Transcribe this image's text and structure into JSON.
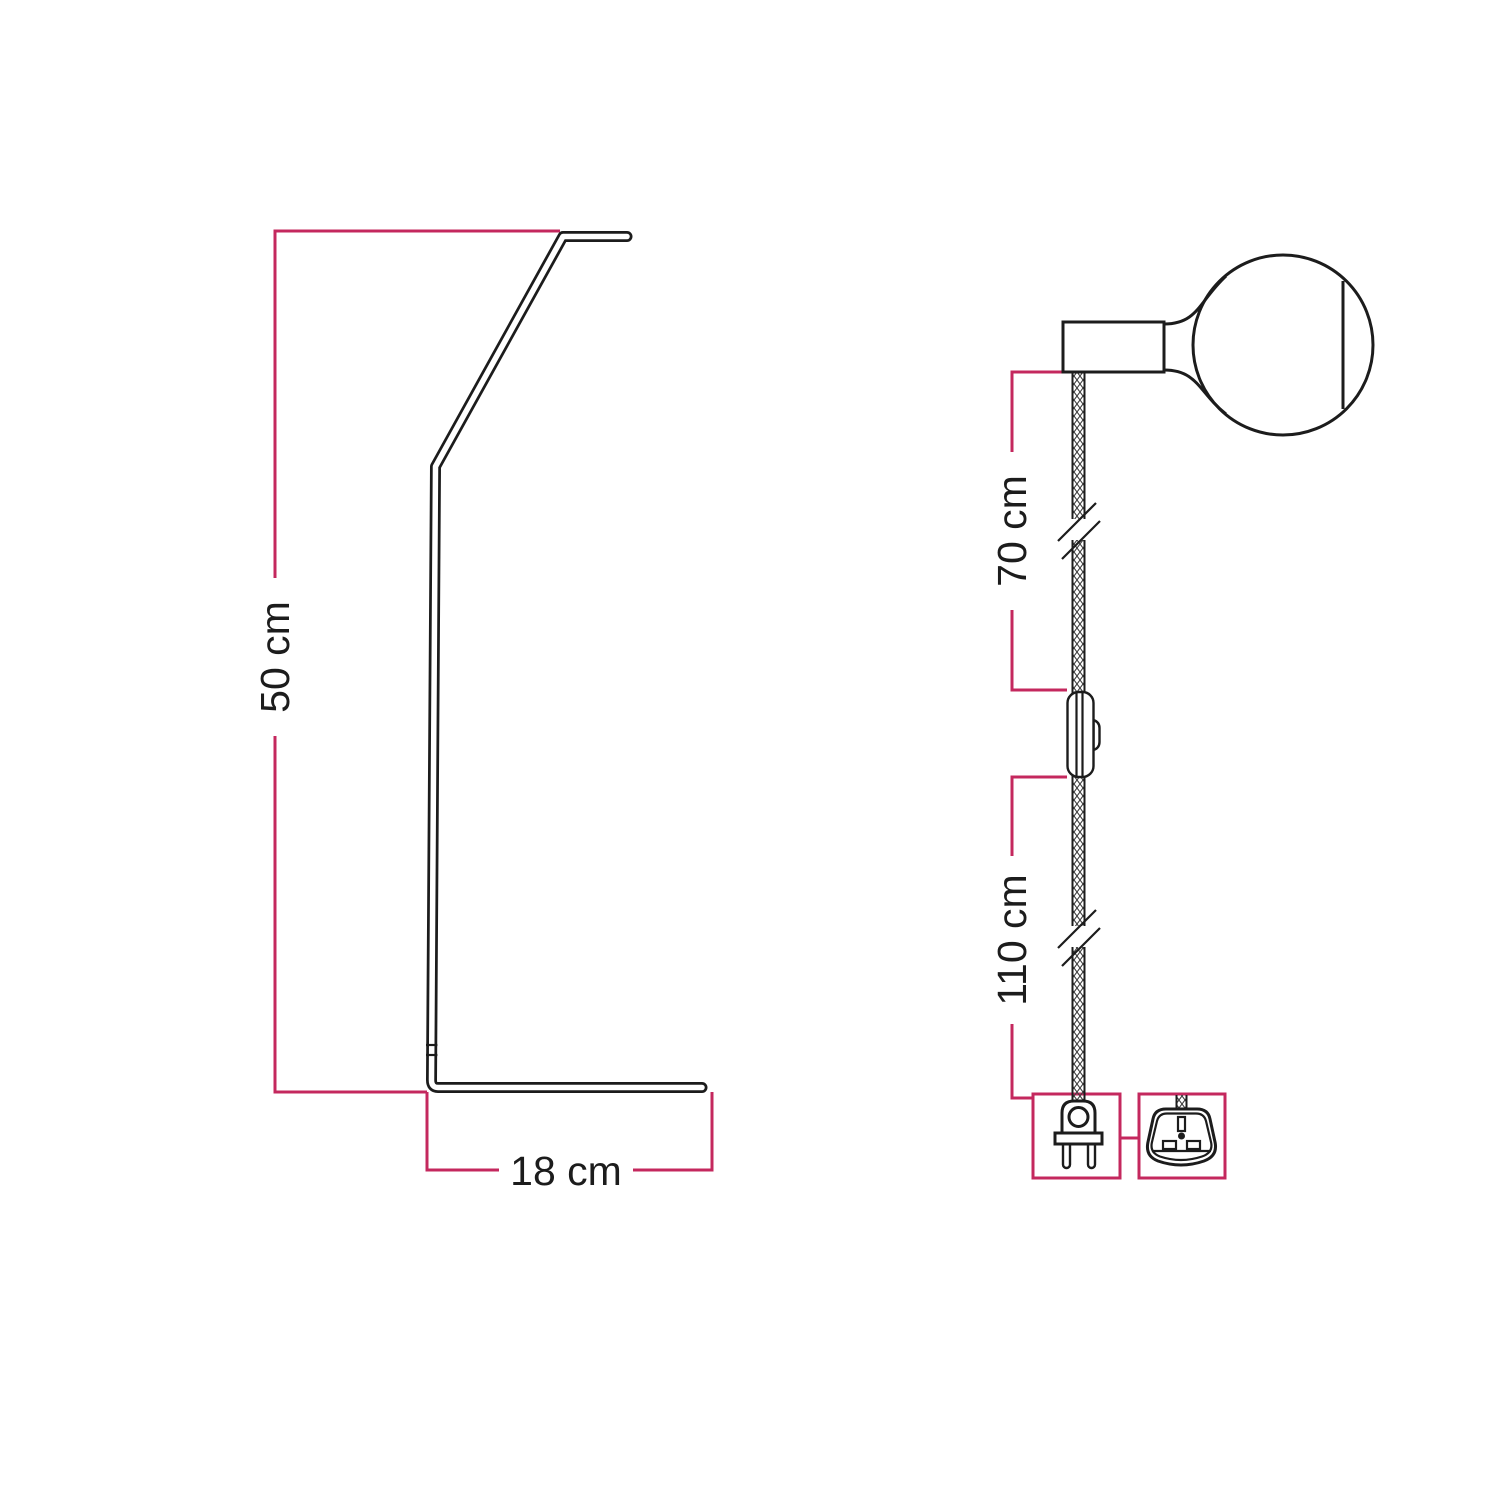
{
  "colors": {
    "ink": "#1c1c1c",
    "dimension": "#c4285e",
    "background": "#ffffff"
  },
  "stand_figure": {
    "height_dimension": "50 cm",
    "base_dimension": "18 cm"
  },
  "pendant_figure": {
    "socket_to_switch_dimension": "70 cm",
    "switch_to_plug_dimension": "110 cm"
  },
  "icons": {
    "euro_plug": "euro-two-pin-plug",
    "uk_plug": "uk-three-pin-plug"
  }
}
